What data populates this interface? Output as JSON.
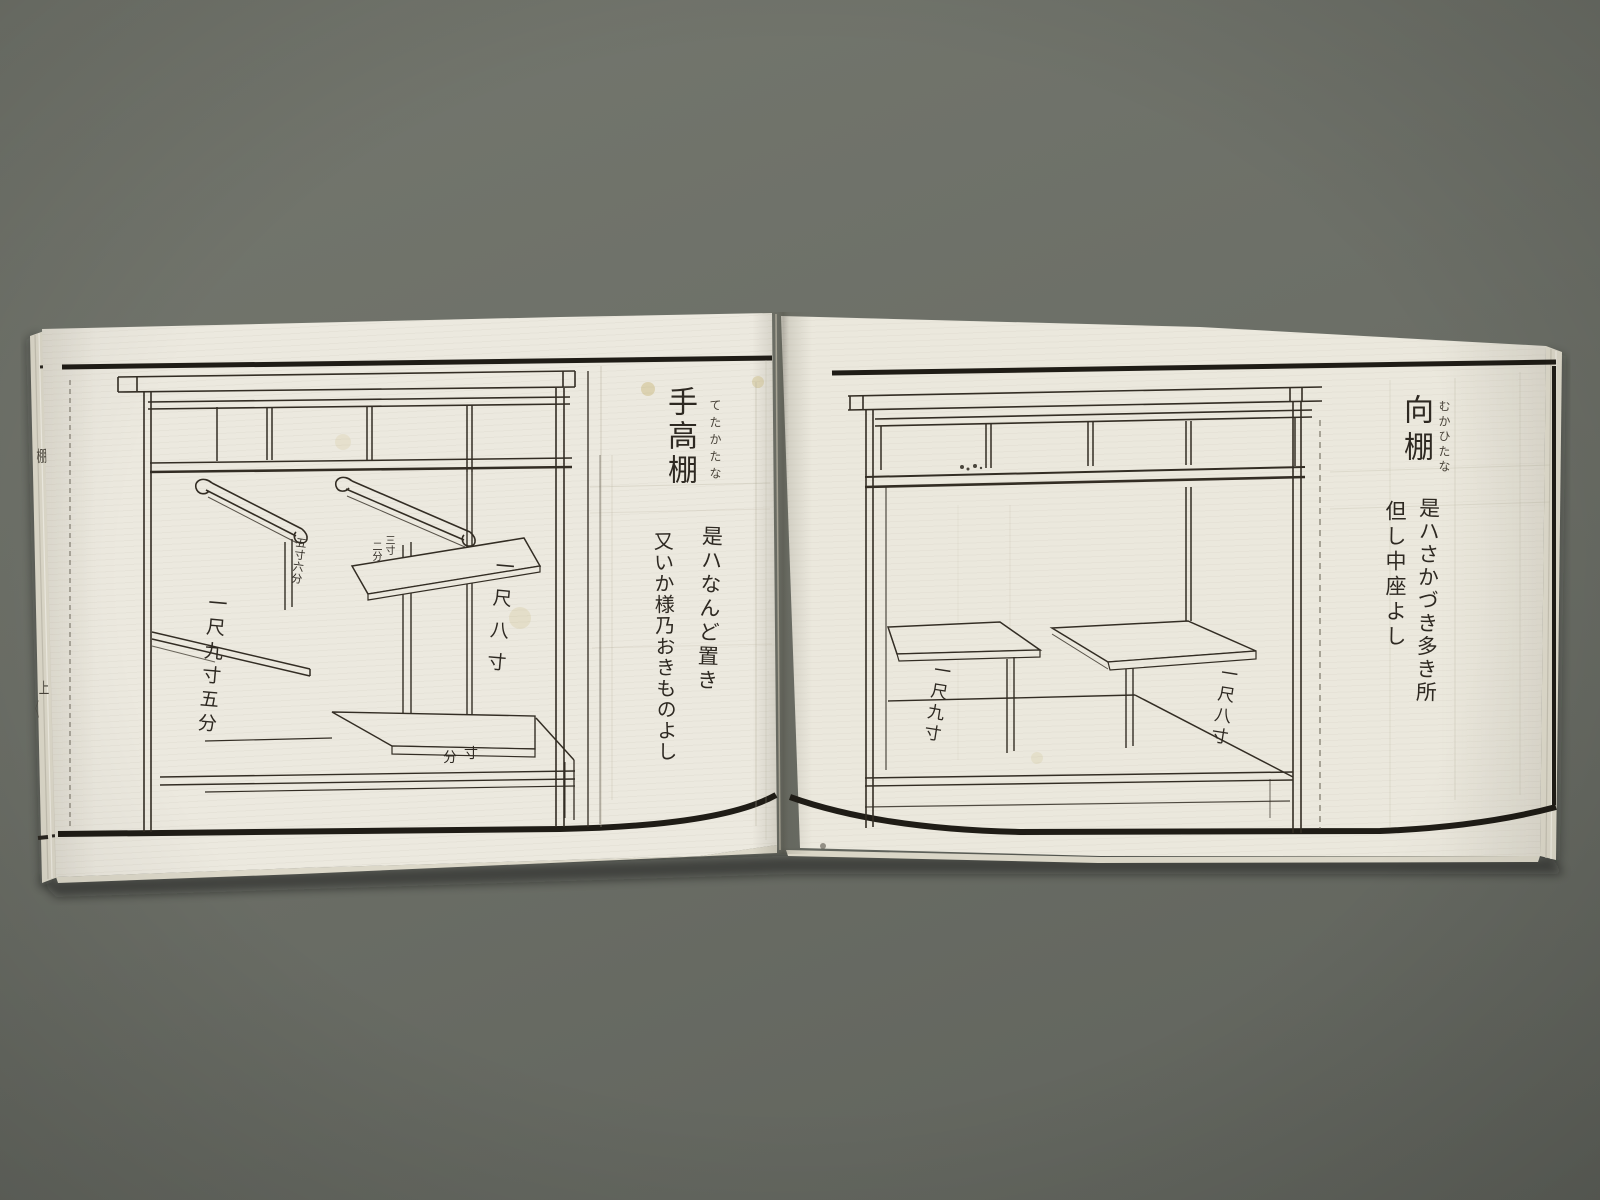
{
  "photo": {
    "description": "Photograph of an open Japanese woodblock-printed pattern book (shelf designs), two-page spread with line drawings and calligraphy",
    "background_color": "#6c6f67",
    "paper_color": "#ebe8de",
    "ink_color": "#2b2720"
  },
  "left_page": {
    "title": "手高棚",
    "furigana": "てたかたな",
    "caption_1": "是ハなんど置き",
    "caption_2": "又いか様乃おきものよし",
    "measure_left": "一尺九寸五分",
    "measure_right": "一尺八寸",
    "note_post_left": "五寸六分",
    "note_post_right_a": "三寸",
    "note_post_right_b": "二分",
    "note_base_a": "寸",
    "note_base_b": "分"
  },
  "right_page": {
    "title": "向棚",
    "furigana": "むかひたな",
    "caption_1": "是ハさかづき多き所",
    "caption_2": "但し中座よし",
    "measure_left": "一尺九寸",
    "measure_right": "一尺八寸"
  },
  "fore_edge": {
    "top_char": "棚",
    "bottom_char": "上",
    "bottom_small": "〳〵"
  }
}
